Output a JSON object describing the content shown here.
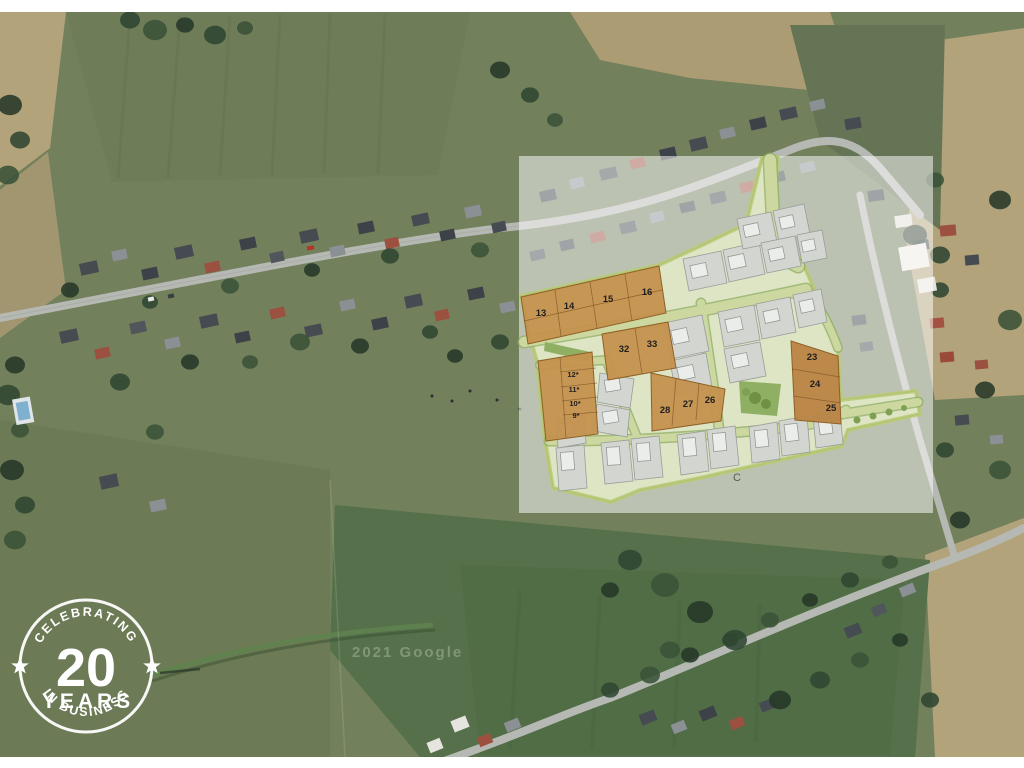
{
  "site_plan": {
    "overlay_color": "#ffffff",
    "highlighted_lots": [
      "13",
      "14",
      "15",
      "16",
      "32",
      "33",
      "12*",
      "11*",
      "10*",
      "9*",
      "28",
      "27",
      "26",
      "23",
      "24",
      "25"
    ],
    "area_label": "C",
    "colors": {
      "highlight_lot": "#c4914e",
      "highlight_lot_dark": "#b98443",
      "plan_base": "#e0e7c6",
      "road": "#ccd89f",
      "green_space": "#8fb062",
      "parcel": "#d2d5d0",
      "building": "#ebedea",
      "label": "#1f1f1f"
    }
  },
  "badge": {
    "top_text": "CELEBRATING",
    "number": "20",
    "middle_text": "YEARS",
    "bottom_text": "IN BUSINESS",
    "color": "#ffffff"
  },
  "watermark": {
    "text": "2021 Google"
  }
}
